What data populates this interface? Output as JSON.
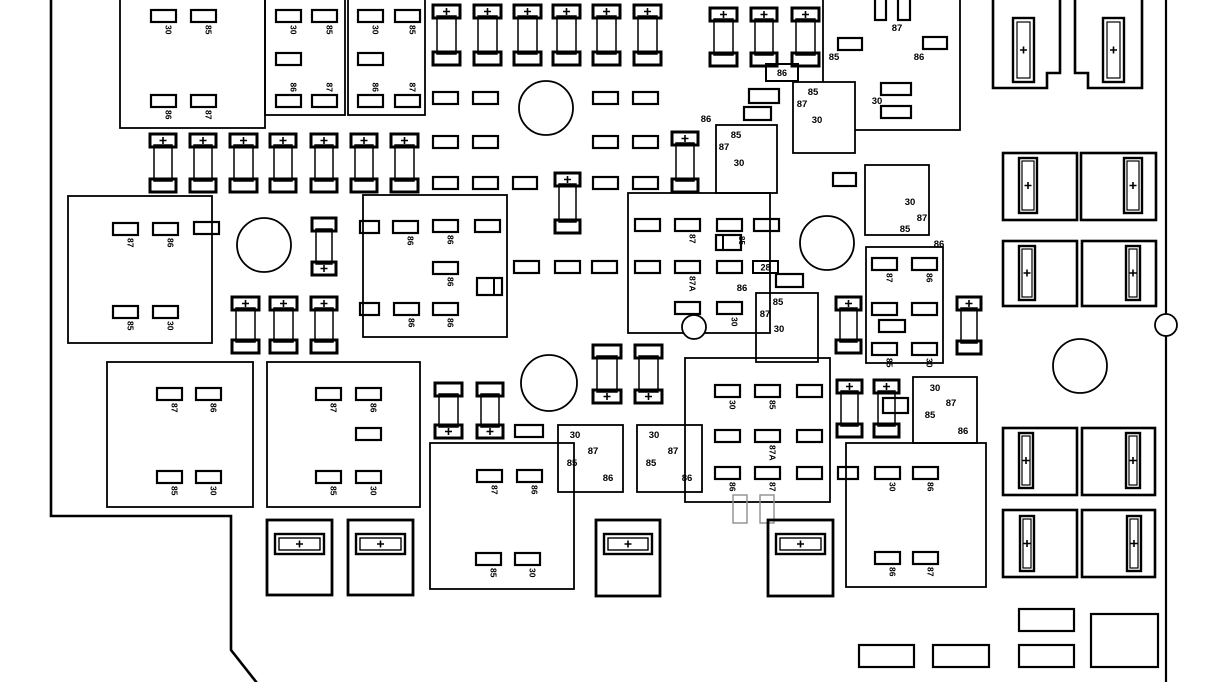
{
  "meta": {
    "width": 1228,
    "height": 682,
    "bg": "#ffffff",
    "ink": "#000000",
    "ghost": "#8f8f8f",
    "plus_glyph": "+"
  },
  "boundary": {
    "left_path": "M51,-3 L51,516 L231,516 L231,650 L257,683",
    "right_path": "M1166,-3 L1166,683",
    "right_circle": {
      "cx": 1166,
      "cy": 325,
      "r": 11
    }
  },
  "relay_blocks": [
    {
      "x": 120,
      "y": -12,
      "w": 145,
      "h": 140
    },
    {
      "x": 265,
      "y": -12,
      "w": 80,
      "h": 127
    },
    {
      "x": 348,
      "y": -12,
      "w": 77,
      "h": 127
    },
    {
      "x": 68,
      "y": 196,
      "w": 144,
      "h": 147
    },
    {
      "x": 363,
      "y": 195,
      "w": 144,
      "h": 142
    },
    {
      "x": 628,
      "y": 193,
      "w": 142,
      "h": 140
    },
    {
      "x": 107,
      "y": 362,
      "w": 146,
      "h": 145
    },
    {
      "x": 267,
      "y": 362,
      "w": 153,
      "h": 145
    },
    {
      "x": 430,
      "y": 443,
      "w": 144,
      "h": 146
    },
    {
      "x": 685,
      "y": 358,
      "w": 145,
      "h": 144
    },
    {
      "x": 846,
      "y": 443,
      "w": 140,
      "h": 144
    },
    {
      "x": 866,
      "y": 247,
      "w": 77,
      "h": 116
    },
    {
      "x": 865,
      "y": 165,
      "w": 64,
      "h": 70
    },
    {
      "x": 913,
      "y": 377,
      "w": 64,
      "h": 66
    },
    {
      "x": 823,
      "y": -12,
      "w": 137,
      "h": 142
    },
    {
      "x": 716,
      "y": 125,
      "w": 61,
      "h": 68
    },
    {
      "x": 793,
      "y": 82,
      "w": 62,
      "h": 71,
      "fill": "#ffffff"
    },
    {
      "x": 756,
      "y": 293,
      "w": 62,
      "h": 69
    },
    {
      "x": 558,
      "y": 425,
      "w": 65,
      "h": 67
    },
    {
      "x": 637,
      "y": 425,
      "w": 65,
      "h": 67
    }
  ],
  "cavities": [
    {
      "x": 151,
      "y": 10,
      "t": "30",
      "p": "b"
    },
    {
      "x": 191,
      "y": 10,
      "t": "85",
      "p": "b"
    },
    {
      "x": 151,
      "y": 95,
      "t": "86",
      "p": "b"
    },
    {
      "x": 191,
      "y": 95,
      "t": "87",
      "p": "b"
    },
    {
      "x": 276,
      "y": 10,
      "t": "30",
      "p": "b"
    },
    {
      "x": 312,
      "y": 10,
      "t": "85",
      "p": "b"
    },
    {
      "x": 276,
      "y": 53
    },
    {
      "x": 276,
      "y": 95,
      "t": "86",
      "p": "a"
    },
    {
      "x": 312,
      "y": 95,
      "t": "87",
      "p": "a"
    },
    {
      "x": 358,
      "y": 10,
      "t": "30",
      "p": "b"
    },
    {
      "x": 395,
      "y": 10,
      "t": "85",
      "p": "b"
    },
    {
      "x": 358,
      "y": 53
    },
    {
      "x": 358,
      "y": 95,
      "t": "86",
      "p": "a"
    },
    {
      "x": 395,
      "y": 95,
      "t": "87",
      "p": "a"
    },
    {
      "x": 113,
      "y": 223,
      "t": "87",
      "p": "b"
    },
    {
      "x": 153,
      "y": 223,
      "t": "86",
      "p": "b"
    },
    {
      "x": 194,
      "y": 222
    },
    {
      "x": 113,
      "y": 306,
      "t": "85",
      "p": "b"
    },
    {
      "x": 153,
      "y": 306,
      "t": "30",
      "p": "b"
    },
    {
      "x": 360,
      "y": 221,
      "w": 19
    },
    {
      "x": 393,
      "y": 221,
      "t": "86",
      "p": "b"
    },
    {
      "x": 433,
      "y": 220,
      "t": "86",
      "p": "b"
    },
    {
      "x": 475,
      "y": 220
    },
    {
      "x": 433,
      "y": 262,
      "t": "86",
      "p": "b"
    },
    {
      "x": 360,
      "y": 303,
      "w": 19
    },
    {
      "x": 394,
      "y": 303,
      "t": "86",
      "p": "b"
    },
    {
      "x": 433,
      "y": 303,
      "t": "86",
      "p": "b"
    },
    {
      "x": 635,
      "y": 219
    },
    {
      "x": 675,
      "y": 219,
      "t": "87",
      "p": "b"
    },
    {
      "x": 717,
      "y": 219
    },
    {
      "x": 754,
      "y": 219
    },
    {
      "x": 635,
      "y": 261
    },
    {
      "x": 675,
      "y": 261,
      "t": "87A",
      "p": "b"
    },
    {
      "x": 717,
      "y": 261
    },
    {
      "x": 675,
      "y": 302
    },
    {
      "x": 717,
      "y": 302,
      "t": "30",
      "p": "b"
    },
    {
      "x": 433,
      "y": 92
    },
    {
      "x": 473,
      "y": 92
    },
    {
      "x": 593,
      "y": 92
    },
    {
      "x": 633,
      "y": 92
    },
    {
      "x": 433,
      "y": 136
    },
    {
      "x": 473,
      "y": 136
    },
    {
      "x": 593,
      "y": 136
    },
    {
      "x": 633,
      "y": 136
    },
    {
      "x": 433,
      "y": 177
    },
    {
      "x": 473,
      "y": 177
    },
    {
      "x": 513,
      "y": 177,
      "w": 24
    },
    {
      "x": 593,
      "y": 177
    },
    {
      "x": 633,
      "y": 177
    },
    {
      "x": 514,
      "y": 261
    },
    {
      "x": 555,
      "y": 261
    },
    {
      "x": 592,
      "y": 261
    },
    {
      "x": 157,
      "y": 388,
      "t": "87",
      "p": "b"
    },
    {
      "x": 196,
      "y": 388,
      "t": "86",
      "p": "b"
    },
    {
      "x": 157,
      "y": 471,
      "t": "85",
      "p": "b"
    },
    {
      "x": 196,
      "y": 471,
      "t": "30",
      "p": "b"
    },
    {
      "x": 316,
      "y": 388,
      "t": "87",
      "p": "b"
    },
    {
      "x": 356,
      "y": 388,
      "t": "86",
      "p": "b"
    },
    {
      "x": 356,
      "y": 428
    },
    {
      "x": 316,
      "y": 471,
      "t": "85",
      "p": "b"
    },
    {
      "x": 356,
      "y": 471,
      "t": "30",
      "p": "b"
    },
    {
      "x": 477,
      "y": 470,
      "t": "87",
      "p": "b"
    },
    {
      "x": 517,
      "y": 470,
      "t": "86",
      "p": "b"
    },
    {
      "x": 476,
      "y": 553,
      "t": "85",
      "p": "b"
    },
    {
      "x": 515,
      "y": 553,
      "t": "30",
      "p": "b"
    },
    {
      "x": 715,
      "y": 385,
      "t": "30",
      "p": "b"
    },
    {
      "x": 755,
      "y": 385,
      "t": "85",
      "p": "b"
    },
    {
      "x": 797,
      "y": 385
    },
    {
      "x": 715,
      "y": 430
    },
    {
      "x": 755,
      "y": 430,
      "t": "87A",
      "p": "b"
    },
    {
      "x": 797,
      "y": 430
    },
    {
      "x": 715,
      "y": 467,
      "t": "86",
      "p": "b"
    },
    {
      "x": 755,
      "y": 467,
      "t": "87",
      "p": "b"
    },
    {
      "x": 797,
      "y": 467
    },
    {
      "x": 838,
      "y": 467,
      "w": 20
    },
    {
      "x": 875,
      "y": 467,
      "t": "30",
      "p": "b"
    },
    {
      "x": 913,
      "y": 467,
      "t": "86",
      "p": "b"
    },
    {
      "x": 875,
      "y": 552,
      "t": "86",
      "p": "b"
    },
    {
      "x": 913,
      "y": 552,
      "t": "87",
      "p": "b"
    },
    {
      "x": 872,
      "y": 258,
      "t": "87",
      "p": "b"
    },
    {
      "x": 912,
      "y": 258,
      "t": "86",
      "p": "b"
    },
    {
      "x": 872,
      "y": 303
    },
    {
      "x": 912,
      "y": 303
    },
    {
      "x": 879,
      "y": 320,
      "w": 26
    },
    {
      "x": 872,
      "y": 343,
      "t": "85",
      "p": "b"
    },
    {
      "x": 912,
      "y": 343,
      "t": "30",
      "p": "b"
    }
  ],
  "plain_rects": [
    {
      "x": 875,
      "y": -6,
      "w": 11,
      "h": 26
    },
    {
      "x": 898,
      "y": -6,
      "w": 12,
      "h": 26
    },
    {
      "x": 838,
      "y": 38,
      "w": 24,
      "h": 12
    },
    {
      "x": 923,
      "y": 37,
      "w": 24,
      "h": 12
    },
    {
      "x": 881,
      "y": 83,
      "w": 30,
      "h": 12
    },
    {
      "x": 881,
      "y": 106,
      "w": 30,
      "h": 12
    },
    {
      "x": 749,
      "y": 89,
      "w": 30,
      "h": 14
    },
    {
      "x": 744,
      "y": 107,
      "w": 27,
      "h": 13
    },
    {
      "x": 833,
      "y": 173,
      "w": 23,
      "h": 13
    },
    {
      "x": 776,
      "y": 274,
      "w": 27,
      "h": 13
    },
    {
      "x": 515,
      "y": 425,
      "w": 28,
      "h": 12
    },
    {
      "x": 883,
      "y": 398,
      "w": 25,
      "h": 15
    },
    {
      "x": 859,
      "y": 645,
      "w": 55,
      "h": 22
    },
    {
      "x": 933,
      "y": 645,
      "w": 56,
      "h": 22
    },
    {
      "x": 1019,
      "y": 609,
      "w": 55,
      "h": 22
    },
    {
      "x": 1019,
      "y": 645,
      "w": 55,
      "h": 22
    },
    {
      "x": 1091,
      "y": 614,
      "w": 67,
      "h": 53
    }
  ],
  "ghost_rects": [
    {
      "x": 733,
      "y": 495,
      "w": 14,
      "h": 28
    },
    {
      "x": 760,
      "y": 495,
      "w": 14,
      "h": 28
    }
  ],
  "split_boxes": [
    {
      "x": 477,
      "y": 278,
      "w": 25,
      "h": 17,
      "div": 17
    },
    {
      "x": 716,
      "y": 235,
      "w": 25,
      "h": 15,
      "div": 7,
      "t": "85"
    }
  ],
  "boxed_labels": [
    {
      "x": 766,
      "y": 64,
      "w": 32,
      "h": 17,
      "t": "86"
    },
    {
      "x": 753,
      "y": 261,
      "w": 25,
      "h": 12,
      "t": "28"
    }
  ],
  "fuses": [
    {
      "x": 433,
      "y": 5,
      "w": 27,
      "h": 60,
      "plus": "t"
    },
    {
      "x": 474,
      "y": 5,
      "w": 27,
      "h": 60,
      "plus": "t"
    },
    {
      "x": 514,
      "y": 5,
      "w": 27,
      "h": 60,
      "plus": "t"
    },
    {
      "x": 553,
      "y": 5,
      "w": 27,
      "h": 60,
      "plus": "t"
    },
    {
      "x": 593,
      "y": 5,
      "w": 27,
      "h": 60,
      "plus": "t"
    },
    {
      "x": 634,
      "y": 5,
      "w": 27,
      "h": 60,
      "plus": "t"
    },
    {
      "x": 710,
      "y": 8,
      "w": 27,
      "h": 58,
      "plus": "t"
    },
    {
      "x": 751,
      "y": 8,
      "w": 26,
      "h": 58,
      "plus": "t"
    },
    {
      "x": 792,
      "y": 8,
      "w": 27,
      "h": 58,
      "plus": "t"
    },
    {
      "x": 150,
      "y": 134,
      "w": 26,
      "h": 58,
      "plus": "t"
    },
    {
      "x": 190,
      "y": 134,
      "w": 26,
      "h": 58,
      "plus": "t"
    },
    {
      "x": 230,
      "y": 134,
      "w": 27,
      "h": 58,
      "plus": "t"
    },
    {
      "x": 270,
      "y": 134,
      "w": 26,
      "h": 58,
      "plus": "t"
    },
    {
      "x": 311,
      "y": 134,
      "w": 26,
      "h": 58,
      "plus": "t"
    },
    {
      "x": 351,
      "y": 134,
      "w": 26,
      "h": 58,
      "plus": "t"
    },
    {
      "x": 391,
      "y": 134,
      "w": 27,
      "h": 58,
      "plus": "t"
    },
    {
      "x": 555,
      "y": 173,
      "w": 25,
      "h": 60,
      "plus": "t"
    },
    {
      "x": 672,
      "y": 132,
      "w": 26,
      "h": 60,
      "plus": "t"
    },
    {
      "x": 312,
      "y": 218,
      "w": 24,
      "h": 57,
      "plus": "b"
    },
    {
      "x": 232,
      "y": 297,
      "w": 27,
      "h": 56,
      "plus": "t"
    },
    {
      "x": 270,
      "y": 297,
      "w": 27,
      "h": 56,
      "plus": "t"
    },
    {
      "x": 311,
      "y": 297,
      "w": 26,
      "h": 56,
      "plus": "t"
    },
    {
      "x": 836,
      "y": 297,
      "w": 25,
      "h": 56,
      "plus": "t"
    },
    {
      "x": 957,
      "y": 297,
      "w": 24,
      "h": 57,
      "plus": "t"
    },
    {
      "x": 837,
      "y": 380,
      "w": 25,
      "h": 57,
      "plus": "t"
    },
    {
      "x": 874,
      "y": 380,
      "w": 25,
      "h": 57,
      "plus": "t"
    },
    {
      "x": 435,
      "y": 383,
      "w": 27,
      "h": 55,
      "plus": "b"
    },
    {
      "x": 477,
      "y": 383,
      "w": 26,
      "h": 55,
      "plus": "b"
    },
    {
      "x": 593,
      "y": 345,
      "w": 28,
      "h": 58,
      "plus": "b"
    },
    {
      "x": 635,
      "y": 345,
      "w": 27,
      "h": 58,
      "plus": "b"
    }
  ],
  "fuse_holders": [
    {
      "x": 267,
      "y": 520,
      "w": 65,
      "h": 75
    },
    {
      "x": 348,
      "y": 520,
      "w": 65,
      "h": 75
    },
    {
      "x": 596,
      "y": 520,
      "w": 64,
      "h": 76
    },
    {
      "x": 768,
      "y": 520,
      "w": 65,
      "h": 76
    }
  ],
  "maxi_fuse_boxes": [
    {
      "x": 1003,
      "y": 153,
      "w": 74,
      "h": 67,
      "sx": 1019,
      "sy": 158,
      "sw": 18,
      "sh": 55
    },
    {
      "x": 1081,
      "y": 153,
      "w": 75,
      "h": 67,
      "sx": 1124,
      "sy": 158,
      "sw": 18,
      "sh": 55
    },
    {
      "x": 1003,
      "y": 241,
      "w": 74,
      "h": 65,
      "sx": 1019,
      "sy": 246,
      "sw": 16,
      "sh": 54
    },
    {
      "x": 1082,
      "y": 241,
      "w": 74,
      "h": 65,
      "sx": 1126,
      "sy": 246,
      "sw": 14,
      "sh": 54
    },
    {
      "x": 1003,
      "y": 428,
      "w": 74,
      "h": 67,
      "sx": 1019,
      "sy": 433,
      "sw": 14,
      "sh": 55
    },
    {
      "x": 1082,
      "y": 428,
      "w": 73,
      "h": 67,
      "sx": 1126,
      "sy": 433,
      "sw": 14,
      "sh": 55
    },
    {
      "x": 1003,
      "y": 510,
      "w": 74,
      "h": 67,
      "sx": 1020,
      "sy": 516,
      "sw": 14,
      "sh": 55
    },
    {
      "x": 1082,
      "y": 510,
      "w": 73,
      "h": 67,
      "sx": 1127,
      "sy": 516,
      "sw": 14,
      "sh": 55
    }
  ],
  "notched_fuse_shapes": [
    {
      "path": "M993,-4 L993,88 L1047,88 L1047,73 L1060,73 L1060,-4",
      "sx": 1013,
      "sy": 18,
      "sw": 21,
      "sh": 64
    },
    {
      "path": "M1142,-4 L1142,88 L1088,88 L1088,73 L1075,73 L1075,-4",
      "sx": 1103,
      "sy": 18,
      "sw": 21,
      "sh": 64
    }
  ],
  "circles": [
    {
      "cx": 546,
      "cy": 108,
      "r": 27
    },
    {
      "cx": 264,
      "cy": 245,
      "r": 27
    },
    {
      "cx": 827,
      "cy": 243,
      "r": 27
    },
    {
      "cx": 549,
      "cy": 383,
      "r": 28
    },
    {
      "cx": 1080,
      "cy": 366,
      "r": 27
    },
    {
      "cx": 694,
      "cy": 327,
      "r": 12
    }
  ],
  "labels": [
    {
      "t": "87",
      "x": 897,
      "y": 31
    },
    {
      "t": "85",
      "x": 834,
      "y": 60
    },
    {
      "t": "86",
      "x": 919,
      "y": 60
    },
    {
      "t": "30",
      "x": 877,
      "y": 104
    },
    {
      "t": "30",
      "x": 910,
      "y": 205
    },
    {
      "t": "87",
      "x": 922,
      "y": 221
    },
    {
      "t": "85",
      "x": 905,
      "y": 232
    },
    {
      "t": "85",
      "x": 736,
      "y": 138
    },
    {
      "t": "87",
      "x": 724,
      "y": 150
    },
    {
      "t": "30",
      "x": 739,
      "y": 166
    },
    {
      "t": "85",
      "x": 813,
      "y": 95
    },
    {
      "t": "87",
      "x": 802,
      "y": 107
    },
    {
      "t": "30",
      "x": 817,
      "y": 123
    },
    {
      "t": "85",
      "x": 778,
      "y": 305
    },
    {
      "t": "87",
      "x": 765,
      "y": 317
    },
    {
      "t": "30",
      "x": 779,
      "y": 332
    },
    {
      "t": "86",
      "x": 706,
      "y": 122
    },
    {
      "t": "86",
      "x": 742,
      "y": 291
    },
    {
      "t": "86",
      "x": 939,
      "y": 247
    },
    {
      "t": "30",
      "x": 575,
      "y": 438
    },
    {
      "t": "87",
      "x": 593,
      "y": 454
    },
    {
      "t": "85",
      "x": 572,
      "y": 466
    },
    {
      "t": "86",
      "x": 608,
      "y": 481
    },
    {
      "t": "30",
      "x": 654,
      "y": 438
    },
    {
      "t": "87",
      "x": 673,
      "y": 454
    },
    {
      "t": "85",
      "x": 651,
      "y": 466
    },
    {
      "t": "86",
      "x": 687,
      "y": 481
    },
    {
      "t": "30",
      "x": 935,
      "y": 391
    },
    {
      "t": "87",
      "x": 951,
      "y": 406
    },
    {
      "t": "85",
      "x": 930,
      "y": 418
    },
    {
      "t": "86",
      "x": 963,
      "y": 434
    }
  ]
}
